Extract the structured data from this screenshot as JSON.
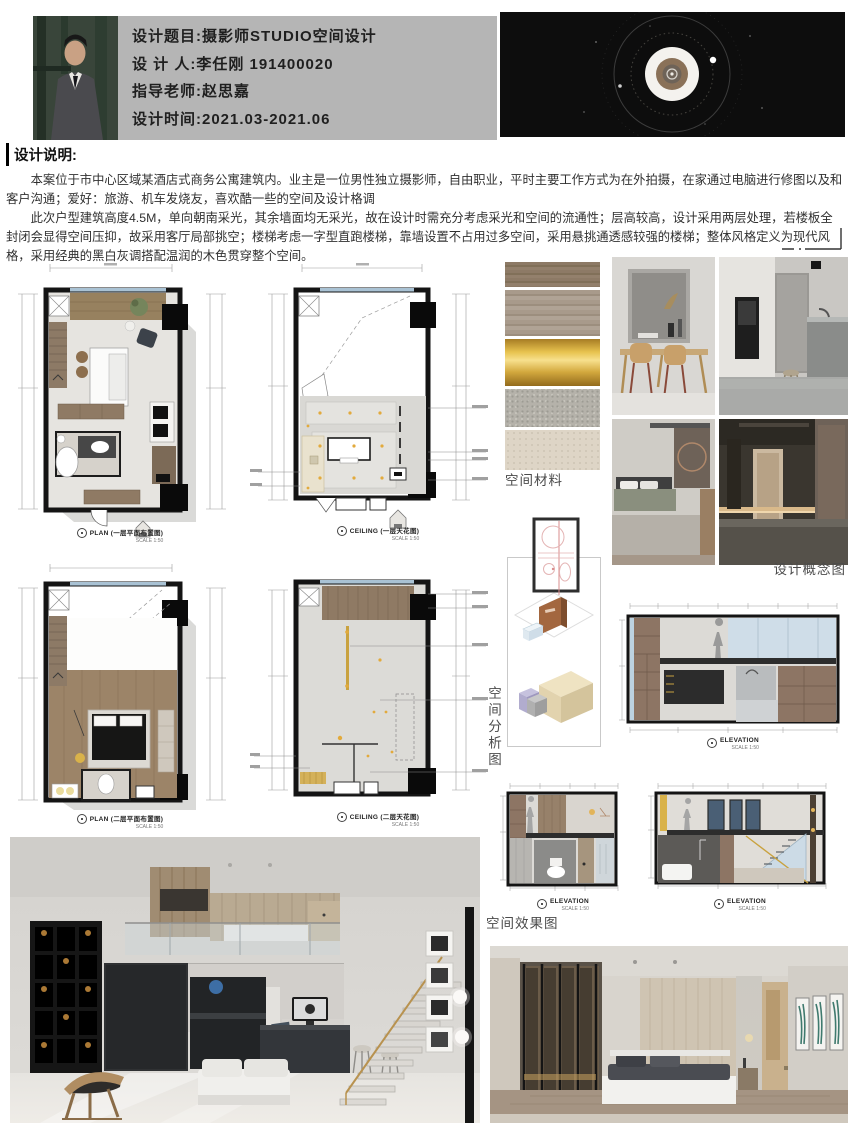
{
  "header": {
    "lines": [
      "设计题目:摄影师STUDIO空间设计",
      "设 计 人:李任刚 191400020",
      "指导老师:赵思嘉",
      "设计时间:2021.03-2021.06"
    ]
  },
  "description": {
    "title": "设计说明:",
    "para1": "本案位于市中心区域某酒店式商务公寓建筑内。业主是一位男性独立摄影师，自由职业，平时主要工作方式为在外拍摄，在家通过电脑进行修图以及和客户沟通；爱好：旅游、机车发烧友，喜欢酷一些的空间及设计格调",
    "para2": "此次户型建筑高度4.5M，单向朝南采光，其余墙面均无采光，故在设计时需充分考虑采光和空间的流通性；层高较高，设计采用两层处理，若楼板全封闭会显得空间压抑，故采用客厅局部挑空；楼梯考虑一字型直跑楼梯，靠墙设置不占用过多空间，采用悬挑通透感较强的楼梯；整体风格定义为现代风格，采用经典的黑白灰调搭配温润的木色贯穿整个空间。"
  },
  "drawings": {
    "plan1_title": "PLAN (一层平面布置图)",
    "ceiling1_title": "CEILING (一层天花图)",
    "plan2_title": "PLAN (二层平面布置图)",
    "ceiling2_title": "CEILING (二层天花图)",
    "elevation_title": "ELEVATION",
    "scale": "SCALE 1:50"
  },
  "sections": {
    "materials": "空间材料",
    "concept": "设计概念图",
    "analysis": "空间分析图",
    "renders": "空间效果图"
  },
  "materials": {
    "swatches": [
      "dark-wood-veneer",
      "light-grey-wood",
      "brushed-gold-metal",
      "grey-terrazzo",
      "beige-stone"
    ],
    "colors": [
      "#8d7a66",
      "#a89a8b",
      "#d9a93f",
      "#b5b2aa",
      "#ded5c6"
    ]
  },
  "accent_colors": {
    "header_panel": "#b5b5b5",
    "lens_background": "#0d0d0d",
    "wood": "#97815f",
    "gold": "#c9a23f"
  }
}
